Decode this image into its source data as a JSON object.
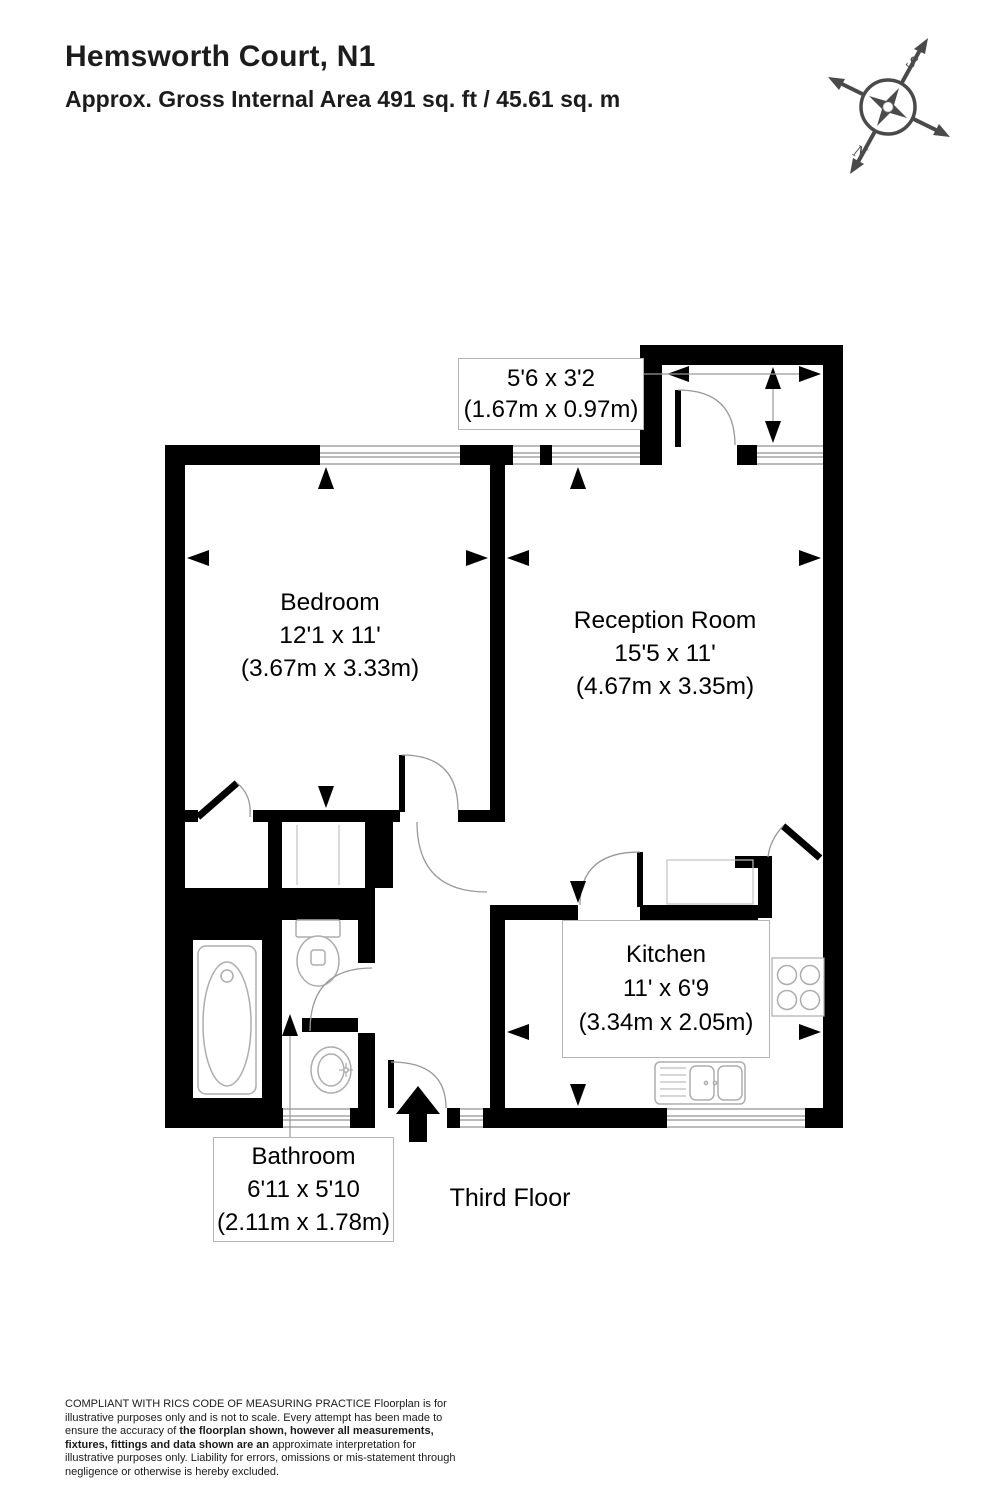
{
  "header": {
    "title": "Hemsworth Court, N1",
    "subtitle": "Approx. Gross Internal Area 491 sq. ft / 45.61 sq. m"
  },
  "compass": {
    "north_label": "N",
    "south_label": "S"
  },
  "floor_label": "Third Floor",
  "rooms": {
    "bedroom": {
      "name": "Bedroom",
      "dimensions_imperial": "12'1 x 11'",
      "dimensions_metric": "(3.67m x 3.33m)"
    },
    "reception": {
      "name": "Reception Room",
      "dimensions_imperial": "15'5 x 11'",
      "dimensions_metric": "(4.67m x 3.35m)"
    },
    "kitchen": {
      "name": "Kitchen",
      "dimensions_imperial": "11' x 6'9",
      "dimensions_metric": "(3.34m x 2.05m)"
    },
    "bathroom": {
      "name": "Bathroom",
      "dimensions_imperial": "6'11 x 5'10",
      "dimensions_metric": "(2.11m x 1.78m)"
    },
    "balcony": {
      "dimensions_imperial": "5'6 x 3'2",
      "dimensions_metric": "(1.67m x 0.97m)"
    }
  },
  "disclaimer": {
    "part1": "COMPLIANT WITH RICS CODE OF MEASURING PRACTICE  Floorplan is for illustrative purposes only and is not to scale. Every attempt has been made to ensure the accuracy of ",
    "part2_bold": "the floorplan shown, however all measurements, fixtures, fittings and data shown are an ",
    "part3": "approximate interpretation for illustrative purposes only. Liability for errors, omissions or mis-statement through negligence or otherwise is hereby excluded."
  },
  "colors": {
    "wall": "#000000",
    "fixture_line": "#adadad",
    "door_arc": "#999999",
    "label_border": "#b5b5b5",
    "compass": "#4a4a4a"
  }
}
